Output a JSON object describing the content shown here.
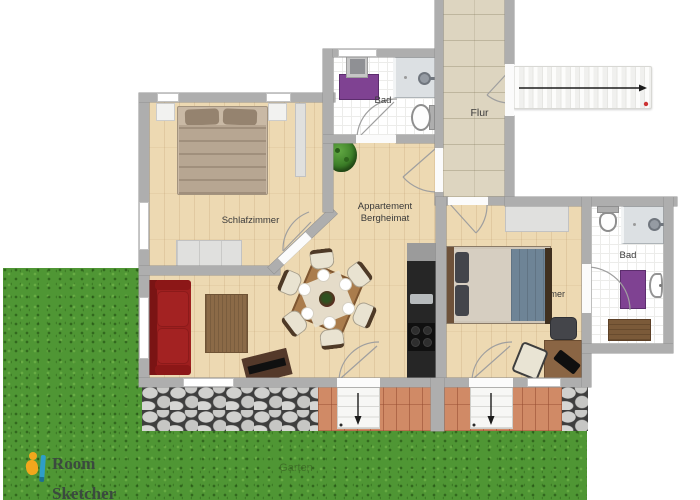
{
  "labels": {
    "bedroom_left": "Schlafzimmer",
    "bathroom_top": "Bad",
    "hallway": "Flur",
    "apartment_line1": "Appartement",
    "apartment_line2": "Bergheimat",
    "bedroom_right": "Schlafzimmer",
    "bathroom_right": "Bad",
    "garden": "Garten"
  },
  "logo": {
    "line1": "Room",
    "line2": "Sketcher"
  },
  "icons": {
    "stairs_direction": "right-arrow",
    "terrace_steps_left": "down-arrow",
    "terrace_steps_right": "down-arrow"
  },
  "colors": {
    "wall": "#aeaeae",
    "wood_floor": "#edd9b2",
    "hall_tile": "#ddd5c0",
    "bath_tile": "#ffffff",
    "grass": "#4f9634",
    "terracotta": "#d08a66",
    "stone_path": "#c9c9c9",
    "sofa_red": "#9e1f1f",
    "rug_purple": "#7f4292",
    "rug_brown": "#8b6a47",
    "blanket_blue": "#6e8496",
    "kitchen_black": "#262626",
    "plant_green": "#3b7d27",
    "logo_orange": "#f2a71c",
    "logo_blue": "#2e9ec9",
    "arrow_black": "#1c1c1c",
    "stair_dot_red": "#cc3333"
  }
}
